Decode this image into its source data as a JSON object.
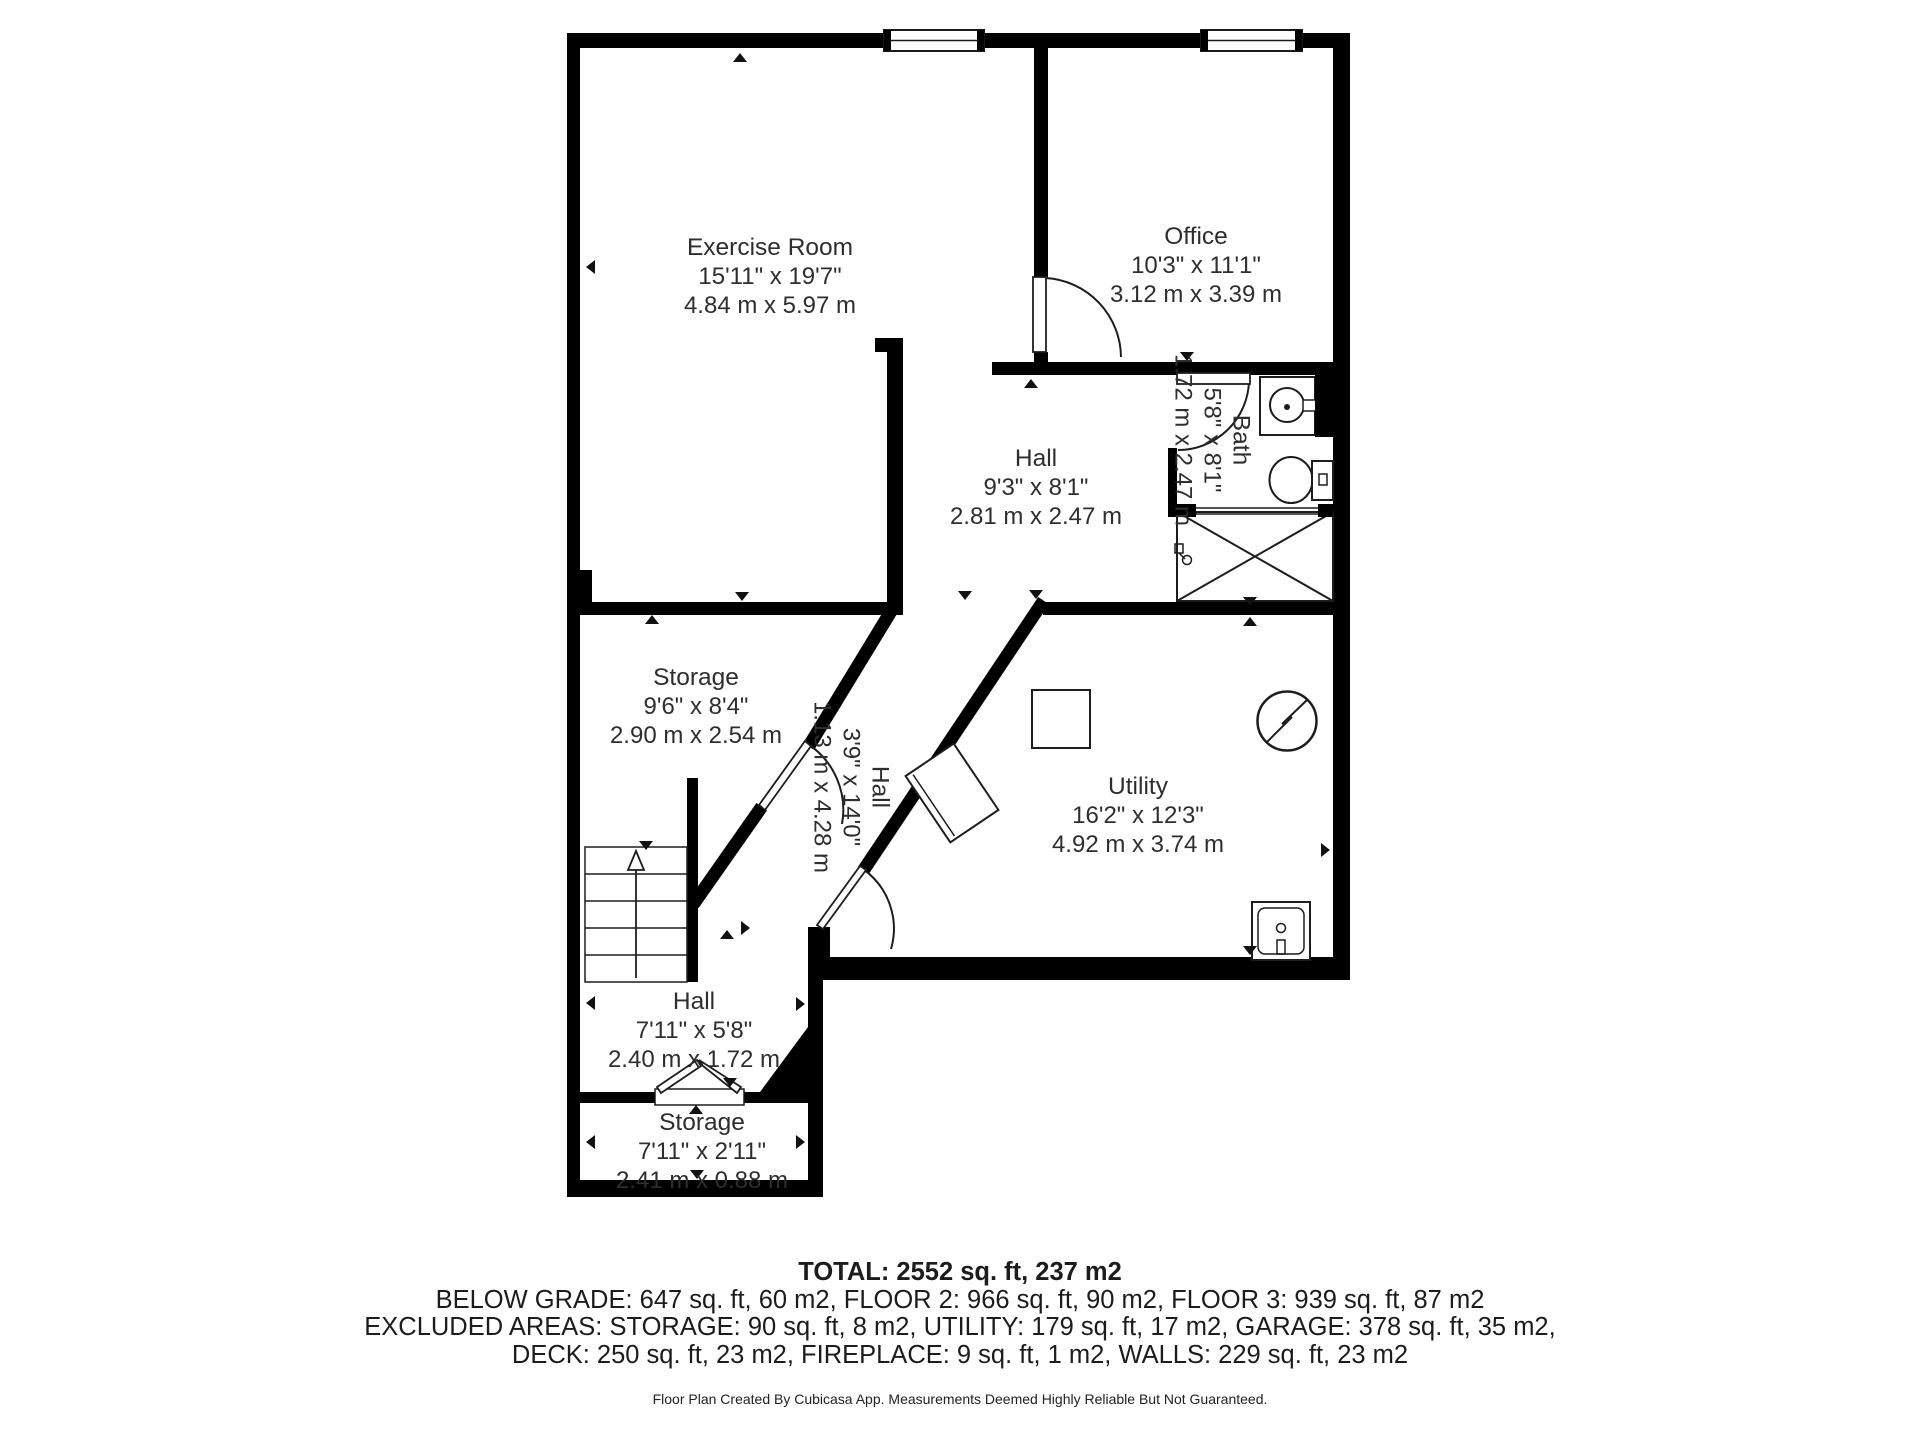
{
  "colors": {
    "wall": "#000000",
    "label_text": "#2e2e2e",
    "summary_text": "#1c1c1c",
    "background": "#ffffff"
  },
  "rooms": {
    "exercise": {
      "name": "Exercise Room",
      "imperial": "15'11\" x 19'7\"",
      "metric": "4.84 m x 5.97 m"
    },
    "office": {
      "name": "Office",
      "imperial": "10'3\" x 11'1\"",
      "metric": "3.12 m x 3.39 m"
    },
    "hall_main": {
      "name": "Hall",
      "imperial": "9'3\" x 8'1\"",
      "metric": "2.81 m x 2.47 m"
    },
    "bath": {
      "name": "Bath",
      "imperial": "5'8\" x 8'1\"",
      "metric": "1.72 m x 2.47 m"
    },
    "storage_upper": {
      "name": "Storage",
      "imperial": "9'6\" x 8'4\"",
      "metric": "2.90 m x 2.54 m"
    },
    "hall_diagonal": {
      "name": "Hall",
      "imperial": "3'9\" x 14'0\"",
      "metric": "1.13 m x 4.28 m"
    },
    "utility": {
      "name": "Utility",
      "imperial": "16'2\" x 12'3\"",
      "metric": "4.92 m x 3.74 m"
    },
    "hall_lower": {
      "name": "Hall",
      "imperial": "7'11\" x 5'8\"",
      "metric": "2.40 m x 1.72 m"
    },
    "storage_lower": {
      "name": "Storage",
      "imperial": "7'11\" x 2'11\"",
      "metric": "2.41 m x 0.88 m"
    }
  },
  "summary": {
    "total": "TOTAL: 2552 sq. ft, 237 m2",
    "floors": "BELOW GRADE: 647 sq. ft, 60 m2, FLOOR 2: 966 sq. ft, 90 m2, FLOOR 3: 939 sq. ft, 87 m2",
    "excluded1": "EXCLUDED AREAS: STORAGE: 90 sq. ft, 8 m2, UTILITY: 179 sq. ft, 17 m2, GARAGE: 378 sq. ft, 35 m2,",
    "excluded2": "DECK: 250 sq. ft, 23 m2, FIREPLACE: 9 sq. ft, 1 m2, WALLS: 229 sq. ft, 23 m2",
    "disclaimer": "Floor Plan Created By Cubicasa App. Measurements Deemed Highly Reliable But Not Guaranteed."
  }
}
